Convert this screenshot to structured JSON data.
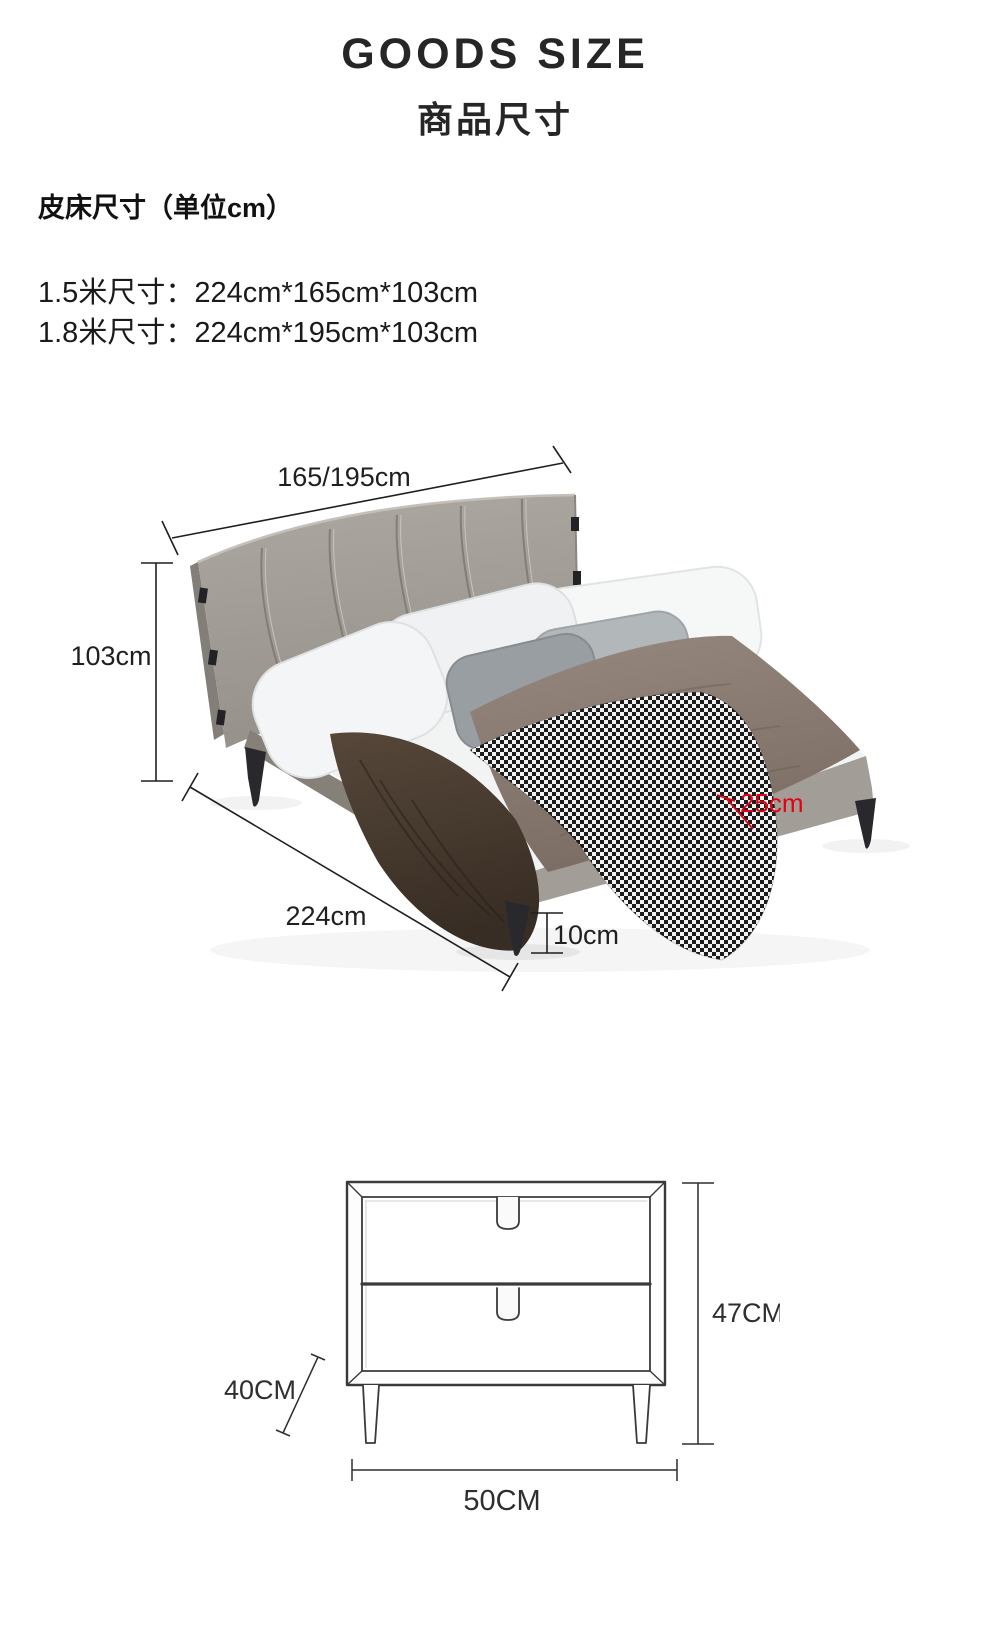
{
  "header": {
    "title_en": "GOODS SIZE",
    "title_cn": "商品尺寸"
  },
  "specs": {
    "intro": "皮床尺寸（单位cm）",
    "sizes": [
      "1.5米尺寸：224cm*165cm*103cm",
      "1.8米尺寸：224cm*195cm*103cm"
    ]
  },
  "bed_diagram": {
    "width_label": "165/195cm",
    "height_label": "103cm",
    "length_label": "224cm",
    "rail_height_label": "25cm",
    "leg_height_label": "10cm",
    "line_color": "#1f1f1f",
    "annotation_color": "#e60012",
    "headboard_color": "#a39e98",
    "rail_color": "#8b8680"
  },
  "nightstand_diagram": {
    "height_label": "47CM",
    "depth_label": "40CM",
    "width_label": "50CM",
    "line_color": "#3a3a3a"
  }
}
